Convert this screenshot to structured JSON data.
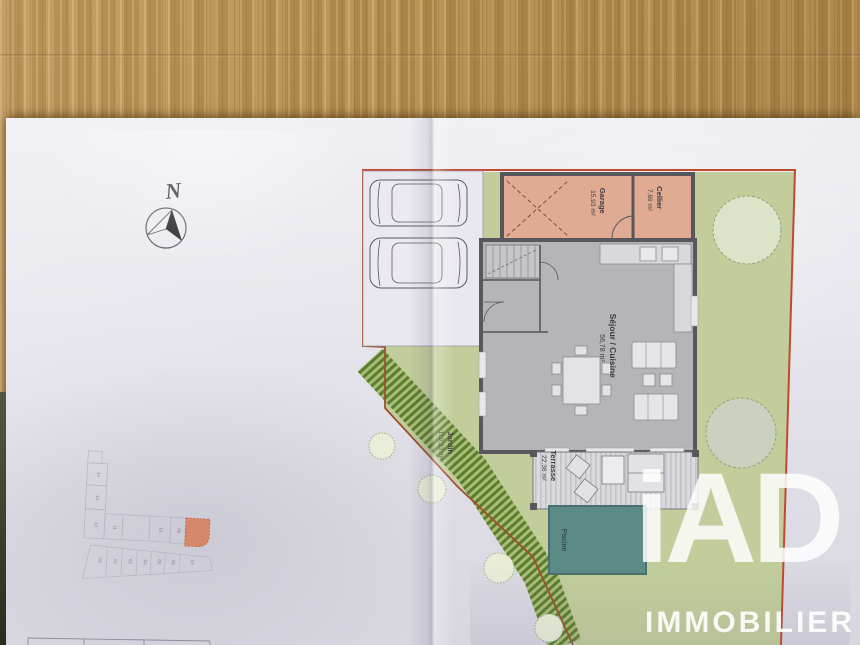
{
  "scene": {
    "description_colors": {
      "wood_table": "#b1874a",
      "paper": "#e7e6ed",
      "boundary_red": "#c04a2e",
      "inner_boundary_brown": "#9c4f2e",
      "room_salmon": "#e0ab92",
      "interior_gray": "#b5b5b9",
      "wall_dark": "#58585c",
      "garden_green": "#c2cd9b",
      "hedge_dark_green": "#5a7d2e",
      "pool_teal": "#5c8a87"
    }
  },
  "compass": {
    "north_label": "N"
  },
  "site_plan": {
    "rooms": [
      {
        "id": "garage",
        "name": "Garage",
        "area": "15,93 m²"
      },
      {
        "id": "cellier",
        "name": "Cellier",
        "area": "7,69 m²"
      },
      {
        "id": "sejour",
        "name": "Séjour / Cuisine",
        "area": "56,78 m²"
      },
      {
        "id": "terrasse",
        "name": "Terrasse",
        "area": "22,36 m²"
      },
      {
        "id": "jardin",
        "name": "Jardin",
        "area": "179,33 m²"
      },
      {
        "id": "piscine",
        "name": "Piscine",
        "area": ""
      }
    ]
  },
  "parcel_map": {
    "lots": [
      "14",
      "13",
      "12",
      "11",
      "10",
      "09",
      "01",
      "02",
      "03",
      "04",
      "05",
      "06",
      "07"
    ],
    "highlighted_lot_color": "#d8886a"
  },
  "watermark": {
    "brand": "iAD",
    "subtitle": "IMMOBILIER"
  }
}
